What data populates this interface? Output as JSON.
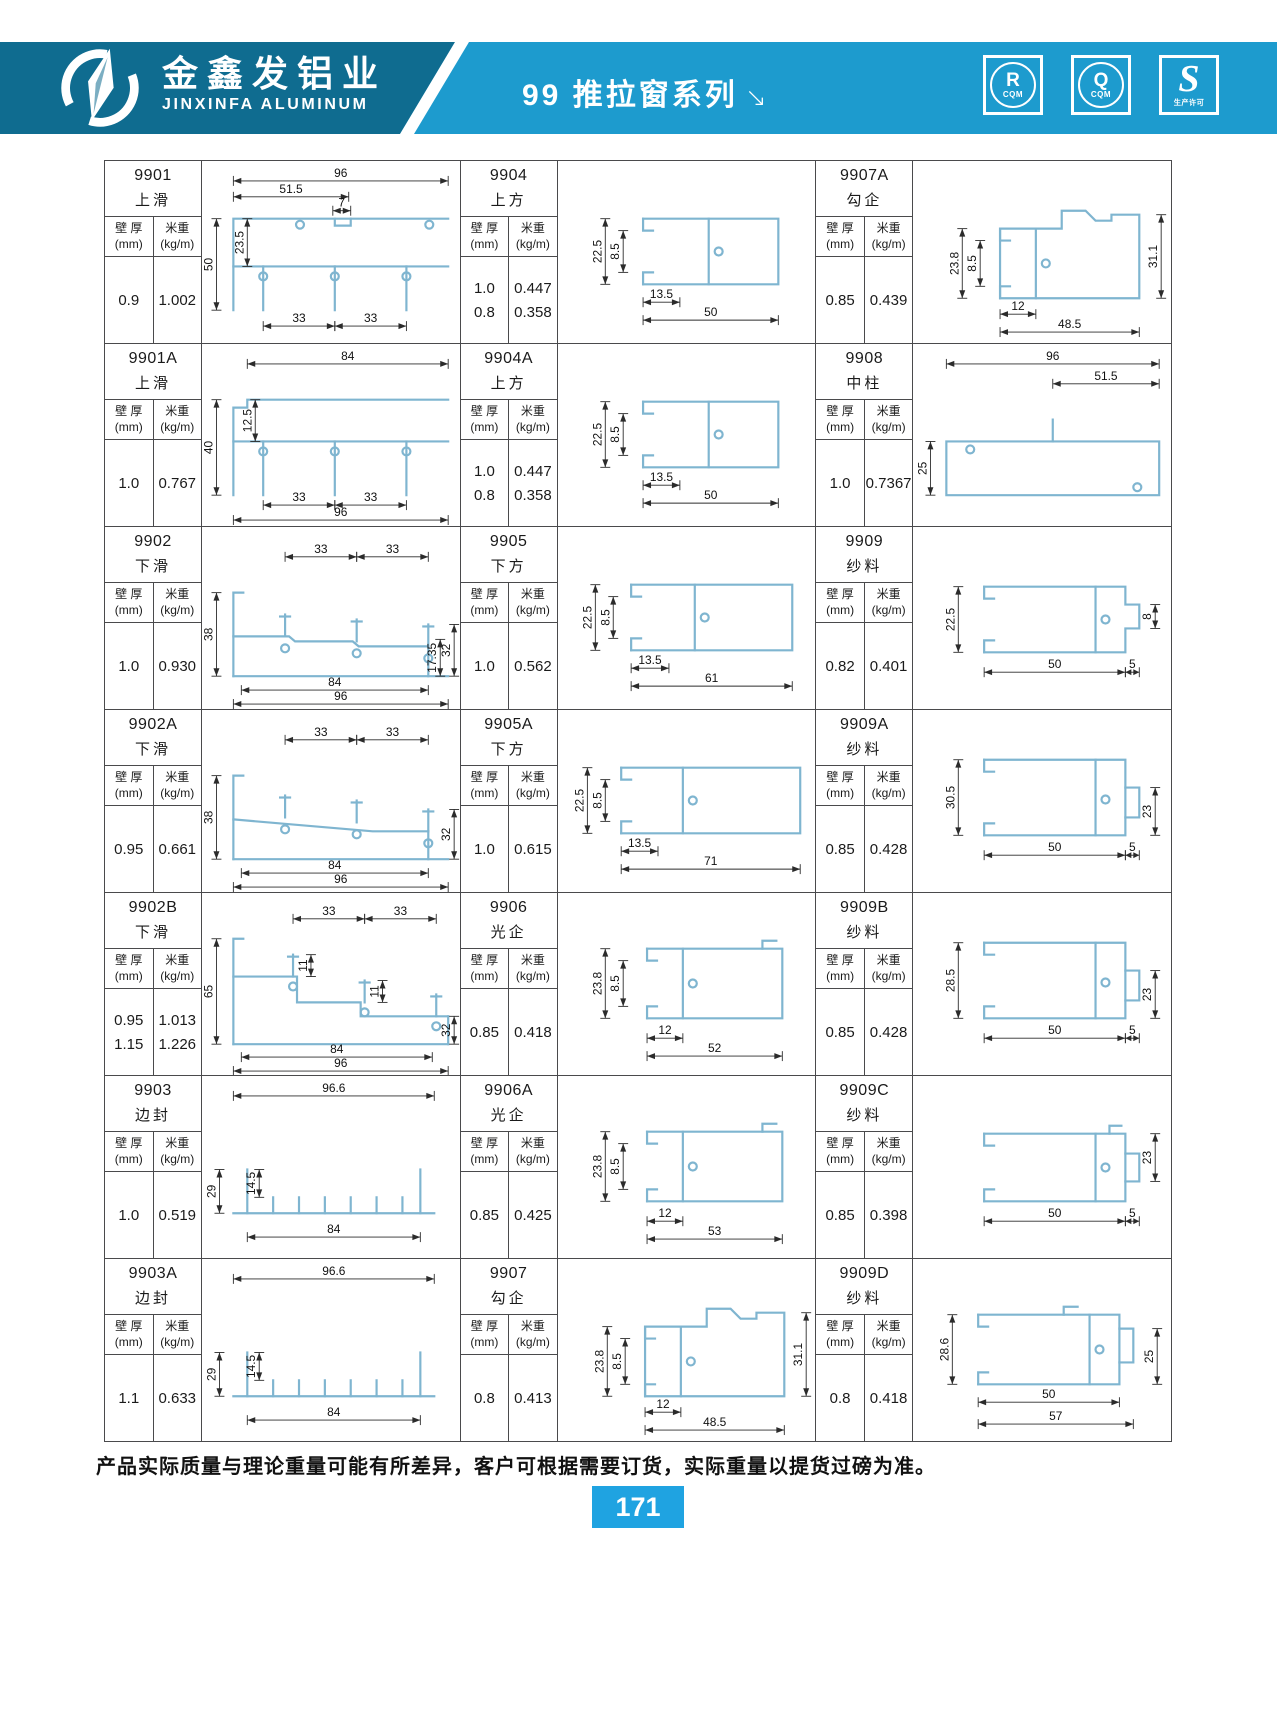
{
  "header": {
    "company_cn": "金鑫发铝业",
    "company_en": "JINXINFA ALUMINUM",
    "series_title": "99 推拉窗系列",
    "arrow": "↘",
    "badges": [
      {
        "letter": "R",
        "sub": "CQM"
      },
      {
        "letter": "Q",
        "sub": "CQM"
      },
      {
        "letter": "S",
        "sub": "生产许可"
      }
    ]
  },
  "colors": {
    "band_dark": "#0F6C90",
    "band_light": "#1D9BCE",
    "page_box_blue": "#1FA3E1",
    "profile_blue": "#7FB5D0",
    "grid_border": "#4A4A4C"
  },
  "table": {
    "col_headers": {
      "thickness": "壁 厚",
      "thickness_unit": "(mm)",
      "weight": "米重",
      "weight_unit": "(kg/m)"
    },
    "cells": [
      {
        "model": "9901",
        "name": "上滑",
        "specs": [
          [
            "0.9",
            "1.002"
          ]
        ],
        "dims": [
          "96",
          "51.5",
          "7",
          "23.5",
          "50",
          "33",
          "33"
        ]
      },
      {
        "model": "9904",
        "name": "上方",
        "specs": [
          [
            "1.0",
            "0.447"
          ],
          [
            "0.8",
            "0.358"
          ]
        ],
        "dims": [
          "22.5",
          "8.5",
          "13.5",
          "50"
        ]
      },
      {
        "model": "9907A",
        "name": "勾企",
        "specs": [
          [
            "0.85",
            "0.439"
          ]
        ],
        "dims": [
          "23.8",
          "8.5",
          "31.1",
          "12",
          "48.5"
        ]
      },
      {
        "model": "9901A",
        "name": "上滑",
        "specs": [
          [
            "1.0",
            "0.767"
          ]
        ],
        "dims": [
          "84",
          "12.5",
          "40",
          "33",
          "33",
          "96"
        ]
      },
      {
        "model": "9904A",
        "name": "上方",
        "specs": [
          [
            "1.0",
            "0.447"
          ],
          [
            "0.8",
            "0.358"
          ]
        ],
        "dims": [
          "22.5",
          "8.5",
          "13.5",
          "50"
        ]
      },
      {
        "model": "9908",
        "name": "中柱",
        "specs": [
          [
            "1.0",
            "0.7367"
          ]
        ],
        "dims": [
          "96",
          "51.5",
          "25"
        ]
      },
      {
        "model": "9902",
        "name": "下滑",
        "specs": [
          [
            "1.0",
            "0.930"
          ]
        ],
        "dims": [
          "33",
          "33",
          "38",
          "32",
          "17.35",
          "84",
          "96"
        ]
      },
      {
        "model": "9905",
        "name": "下方",
        "specs": [
          [
            "1.0",
            "0.562"
          ]
        ],
        "dims": [
          "22.5",
          "8.5",
          "13.5",
          "61"
        ]
      },
      {
        "model": "9909",
        "name": "纱料",
        "specs": [
          [
            "0.82",
            "0.401"
          ]
        ],
        "dims": [
          "22.5",
          "8",
          "50",
          "5"
        ]
      },
      {
        "model": "9902A",
        "name": "下滑",
        "specs": [
          [
            "0.95",
            "0.661"
          ]
        ],
        "dims": [
          "33",
          "33",
          "38",
          "32",
          "84",
          "96"
        ]
      },
      {
        "model": "9905A",
        "name": "下方",
        "specs": [
          [
            "1.0",
            "0.615"
          ]
        ],
        "dims": [
          "22.5",
          "8.5",
          "13.5",
          "71"
        ]
      },
      {
        "model": "9909A",
        "name": "纱料",
        "specs": [
          [
            "0.85",
            "0.428"
          ]
        ],
        "dims": [
          "30.5",
          "23",
          "50",
          "5"
        ]
      },
      {
        "model": "9902B",
        "name": "下滑",
        "specs": [
          [
            "0.95",
            "1.013"
          ],
          [
            "1.15",
            "1.226"
          ]
        ],
        "dims": [
          "33",
          "33",
          "11",
          "11",
          "65",
          "32",
          "84",
          "96"
        ]
      },
      {
        "model": "9906",
        "name": "光企",
        "specs": [
          [
            "0.85",
            "0.418"
          ]
        ],
        "dims": [
          "23.8",
          "8.5",
          "12",
          "52"
        ]
      },
      {
        "model": "9909B",
        "name": "纱料",
        "specs": [
          [
            "0.85",
            "0.428"
          ]
        ],
        "dims": [
          "28.5",
          "23",
          "50",
          "5"
        ]
      },
      {
        "model": "9903",
        "name": "边封",
        "specs": [
          [
            "1.0",
            "0.519"
          ]
        ],
        "dims": [
          "96.6",
          "14.5",
          "29",
          "84"
        ]
      },
      {
        "model": "9906A",
        "name": "光企",
        "specs": [
          [
            "0.85",
            "0.425"
          ]
        ],
        "dims": [
          "23.8",
          "8.5",
          "12",
          "53"
        ]
      },
      {
        "model": "9909C",
        "name": "纱料",
        "specs": [
          [
            "0.85",
            "0.398"
          ]
        ],
        "dims": [
          "23",
          "50",
          "5"
        ]
      },
      {
        "model": "9903A",
        "name": "边封",
        "specs": [
          [
            "1.1",
            "0.633"
          ]
        ],
        "dims": [
          "96.6",
          "14.5",
          "29",
          "84"
        ]
      },
      {
        "model": "9907",
        "name": "勾企",
        "specs": [
          [
            "0.8",
            "0.413"
          ]
        ],
        "dims": [
          "23.8",
          "8.5",
          "31.1",
          "12",
          "48.5"
        ]
      },
      {
        "model": "9909D",
        "name": "纱料",
        "specs": [
          [
            "0.8",
            "0.418"
          ]
        ],
        "dims": [
          "28.6",
          "25",
          "50",
          "57"
        ]
      }
    ]
  },
  "footer": {
    "note": "产品实际质量与理论重量可能有所差异，客户可根据需要订货，实际重量以提货过磅为准。",
    "page": "171"
  }
}
